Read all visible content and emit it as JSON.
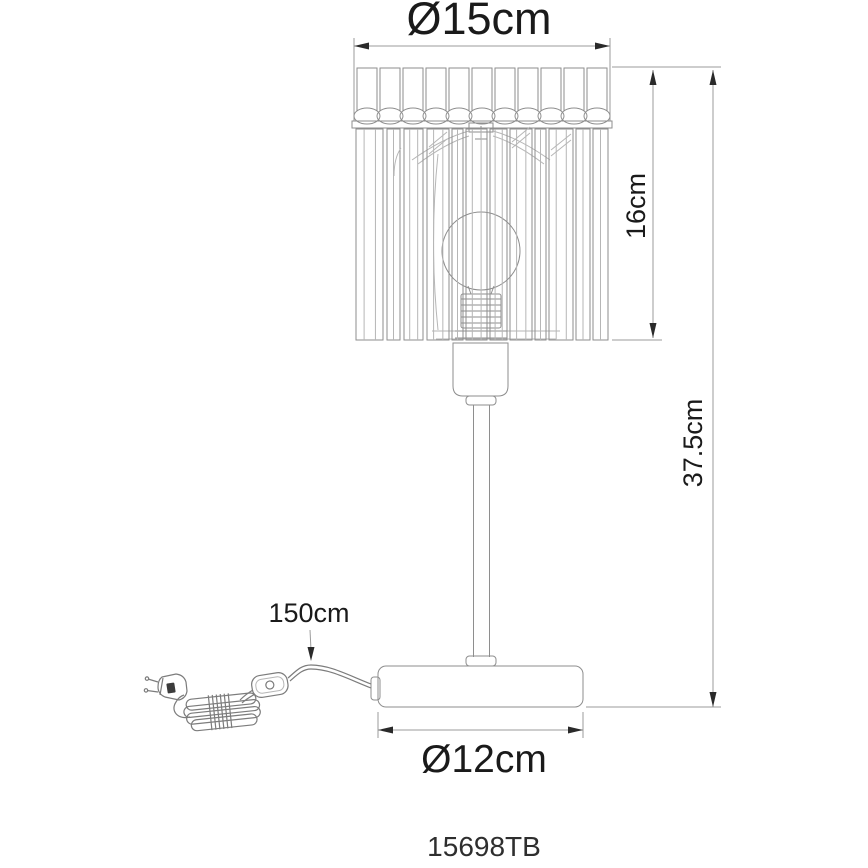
{
  "diagram": {
    "product_code": "15698TB",
    "dimensions": {
      "shade_diameter_label": "Ø15cm",
      "shade_height_label": "16cm",
      "total_height_label": "37.5cm",
      "cable_length_label": "150cm",
      "base_diameter_label": "Ø12cm"
    },
    "colors": {
      "line": "#8e8e8e",
      "line_light": "#b6b6b6",
      "dimension_line": "#9b9b9b",
      "arrow": "#2a2a2a",
      "text": "#1a1a1a",
      "cable": "#7c7c7c",
      "plug_dark": "#3c3c3c",
      "background": "#ffffff"
    }
  }
}
